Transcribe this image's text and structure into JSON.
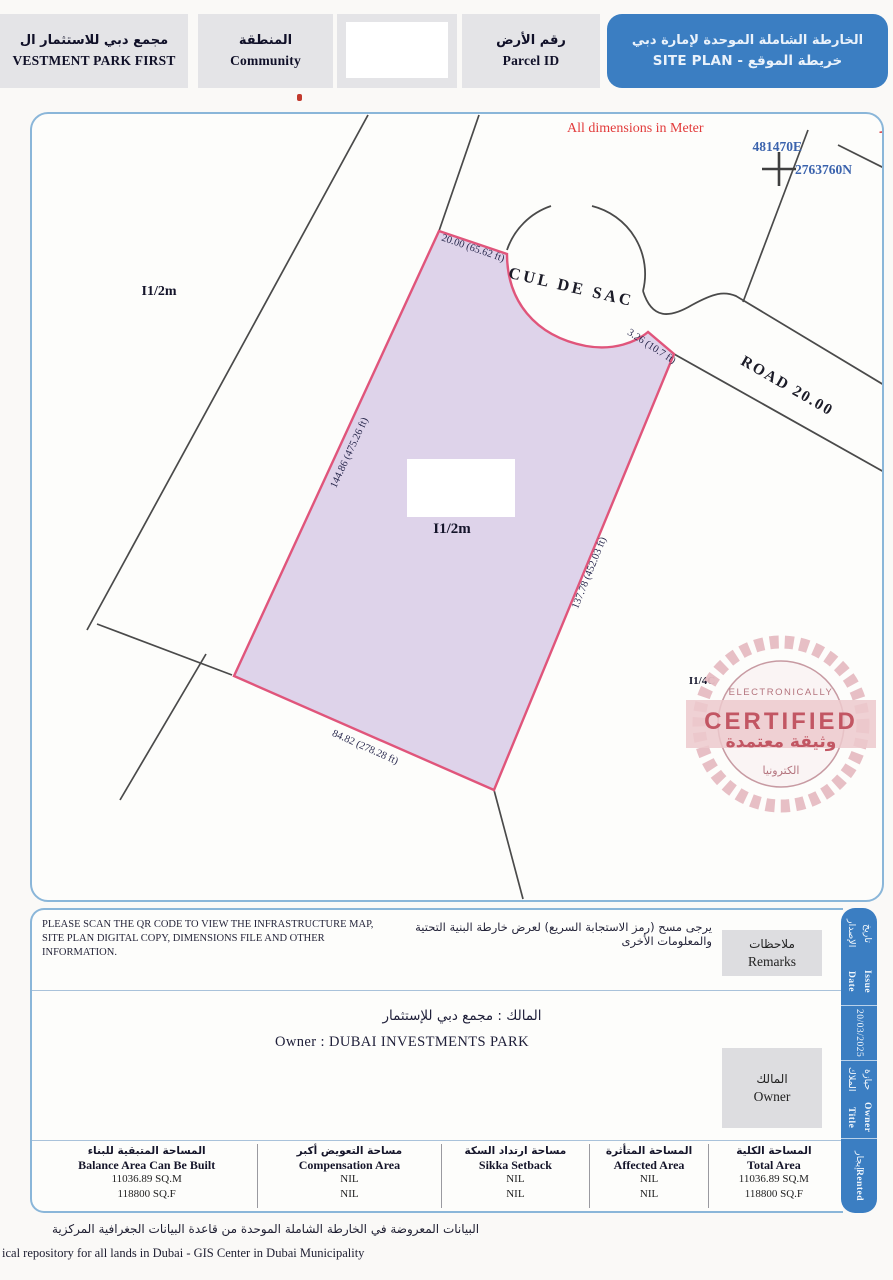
{
  "header": {
    "project": {
      "ar": "مجمع دبي للاستثمار ال",
      "en": "VESTMENT PARK FIRST"
    },
    "community": {
      "ar": "المنطقة",
      "en": "Community"
    },
    "parcel": {
      "ar": "رقم الأرض",
      "en": "Parcel ID"
    },
    "title": {
      "ar": "الخارطة الشاملة الموحدة لإمارة دبي",
      "line2": "خريطة الموقع - SITE PLAN"
    }
  },
  "map": {
    "note_en": "All dimensions in Meter",
    "note_ar": "المقياس المستخدم هو المتر",
    "easting": "481470E",
    "northing": "2763760N",
    "cul_de_sac": "CUL DE SAC",
    "road": "ROAD 20.00",
    "parcel_label_left": "I1/2m",
    "parcel_label_main": "I1/2m",
    "parcel_label_small": "I1/4C",
    "dim_top": "20.00 (65.62 ft)",
    "dim_corner": "3.26 (10.7 ft)",
    "dim_left": "144.86 (475.26 ft)",
    "dim_right": "137.78 (452.03 ft)",
    "dim_bottom": "84.82 (278.28 ft)"
  },
  "stamp": {
    "line1": "ELECTRONICALLY",
    "line2": "CERTIFIED",
    "line3": "وثيقة معتمدة",
    "line4": "الكترونيا"
  },
  "remarks": {
    "label_ar": "ملاحظات",
    "label_en": "Remarks",
    "text_en": "PLEASE SCAN THE QR CODE TO VIEW THE INFRASTRUCTURE MAP,\nSITE PLAN DIGITAL COPY, DIMENSIONS FILE AND OTHER\nINFORMATION.",
    "text_ar": "يرجى مسح (رمز الاستجابة السريع) لعرض خارطة البنية التحتية والمعلومات الأخرى"
  },
  "owner": {
    "label_ar": "المالك",
    "label_en": "Owner",
    "value_ar": "المالك : مجمع دبي للإستثمار",
    "value_en": "Owner : DUBAI INVESTMENTS PARK"
  },
  "sidebar": {
    "issue_date_ar": "تاريخ الإصدار",
    "issue_date_en": "Issue Date",
    "date": "20/03/2025",
    "owner_title_ar": "حيازة الملاك",
    "owner_title_en": "Owner Title",
    "tenure_ar": "إيجار",
    "tenure_en": "Rented"
  },
  "table": {
    "columns": [
      {
        "ar": "المساحة المتبقية للبناء",
        "en": "Balance Area Can Be Built",
        "v1": "11036.89 SQ.M",
        "v2": "118800 SQ.F"
      },
      {
        "ar": "مساحة التعويض أكبر",
        "en": "Compensation Area",
        "v1": "NIL",
        "v2": "NIL"
      },
      {
        "ar": "مساحة ارتداد السكة",
        "en": "Sikka Setback",
        "v1": "NIL",
        "v2": "NIL"
      },
      {
        "ar": "المساحة المتأثرة",
        "en": "Affected Area",
        "v1": "NIL",
        "v2": "NIL"
      },
      {
        "ar": "المساحة الكلية",
        "en": "Total Area",
        "v1": "11036.89 SQ.M",
        "v2": "118800 SQ.F"
      }
    ]
  },
  "footer": {
    "ar": "البيانات المعروضة في الخارطة الشاملة الموحدة من قاعدة البيانات الجغرافية المركزية",
    "en": "ical repository for all lands in Dubai - GIS Center in Dubai Municipality"
  },
  "colors": {
    "accent_blue": "#3b7ec2",
    "map_border_blue": "#8ab6d9",
    "plot_fill": "#dcd0e8",
    "plot_stroke": "#e0557b",
    "note_red": "#e23b3b",
    "coord_blue": "#3b63ad",
    "stamp_pink": "#c25663"
  }
}
